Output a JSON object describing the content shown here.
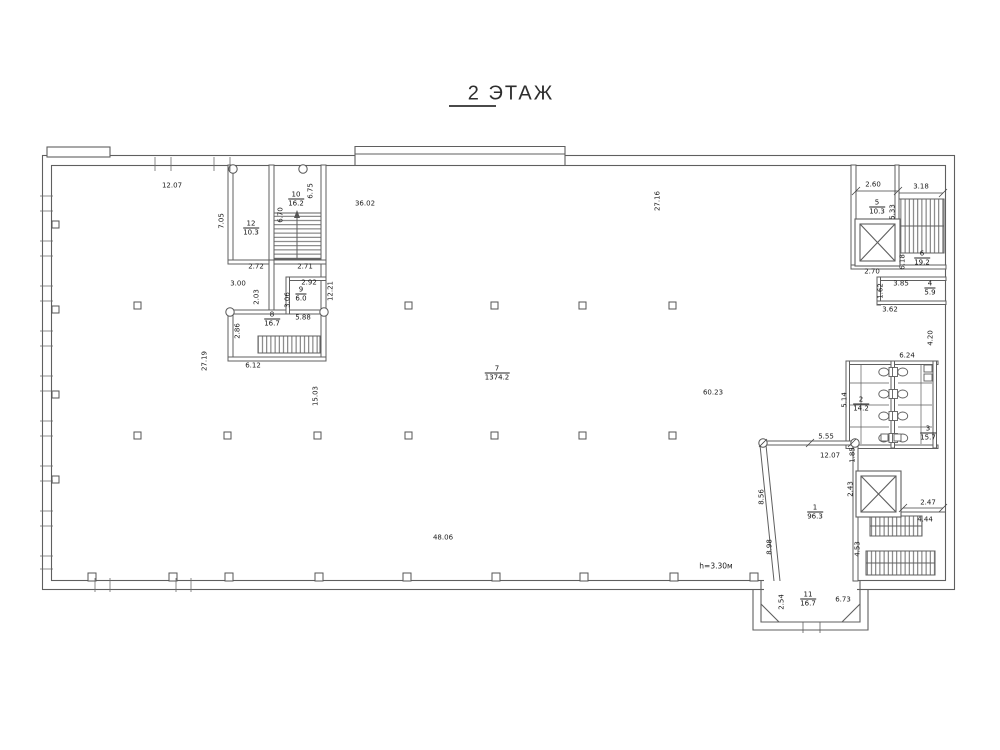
{
  "title": {
    "text": "2 ЭТАЖ"
  },
  "plan": {
    "colors": {
      "line": "#5f5f5f",
      "text": "#1c1c1c",
      "background": "#ffffff"
    },
    "floor_height_note": {
      "text": "h=3.30м",
      "x": 716,
      "y": 566
    },
    "rooms": [
      {
        "number": "12",
        "area": "10.3",
        "x": 251,
        "y": 228
      },
      {
        "number": "10",
        "area": "16.2",
        "x": 296,
        "y": 199
      },
      {
        "number": "9",
        "area": "6.0",
        "x": 301,
        "y": 294
      },
      {
        "number": "8",
        "area": "16.7",
        "x": 272,
        "y": 319
      },
      {
        "number": "7",
        "area": "1374.2",
        "x": 497,
        "y": 373
      },
      {
        "number": "5",
        "area": "10.3",
        "x": 877,
        "y": 207
      },
      {
        "number": "6",
        "area": "19.2",
        "x": 922,
        "y": 258
      },
      {
        "number": "4",
        "area": "5.9",
        "x": 930,
        "y": 288
      },
      {
        "number": "2",
        "area": "14.2",
        "x": 861,
        "y": 404
      },
      {
        "number": "3",
        "area": "15.7",
        "x": 928,
        "y": 433
      },
      {
        "number": "1",
        "area": "96.3",
        "x": 815,
        "y": 512
      },
      {
        "number": "11",
        "area": "16.7",
        "x": 808,
        "y": 599
      }
    ],
    "h_dims": [
      {
        "text": "12.07",
        "x": 172,
        "y": 186
      },
      {
        "text": "36.02",
        "x": 365,
        "y": 204
      },
      {
        "text": "2.60",
        "x": 873,
        "y": 185
      },
      {
        "text": "3.18",
        "x": 921,
        "y": 187
      },
      {
        "text": "2.70",
        "x": 872,
        "y": 272
      },
      {
        "text": "3.85",
        "x": 901,
        "y": 284
      },
      {
        "text": "3.62",
        "x": 890,
        "y": 310
      },
      {
        "text": "6.24",
        "x": 907,
        "y": 356
      },
      {
        "text": "2.72",
        "x": 256,
        "y": 267
      },
      {
        "text": "2.71",
        "x": 305,
        "y": 267
      },
      {
        "text": "3.00",
        "x": 238,
        "y": 284
      },
      {
        "text": "2.92",
        "x": 309,
        "y": 283
      },
      {
        "text": "5.88",
        "x": 303,
        "y": 318
      },
      {
        "text": "6.12",
        "x": 253,
        "y": 366
      },
      {
        "text": "5.55",
        "x": 826,
        "y": 437
      },
      {
        "text": "12.07",
        "x": 830,
        "y": 456
      },
      {
        "text": "60.23",
        "x": 713,
        "y": 393
      },
      {
        "text": "48.06",
        "x": 443,
        "y": 538
      },
      {
        "text": "2.47",
        "x": 928,
        "y": 503
      },
      {
        "text": "4.44",
        "x": 925,
        "y": 520
      },
      {
        "text": "6.73",
        "x": 843,
        "y": 600
      }
    ],
    "v_dims": [
      {
        "text": "7.05",
        "x": 222,
        "y": 221
      },
      {
        "text": "6.70",
        "x": 281,
        "y": 215
      },
      {
        "text": "6.75",
        "x": 311,
        "y": 191
      },
      {
        "text": "27.16",
        "x": 658,
        "y": 201
      },
      {
        "text": "5.33",
        "x": 893,
        "y": 212
      },
      {
        "text": "6.18",
        "x": 903,
        "y": 262
      },
      {
        "text": "1.62",
        "x": 881,
        "y": 291
      },
      {
        "text": "4.20",
        "x": 931,
        "y": 338
      },
      {
        "text": "5.14",
        "x": 845,
        "y": 400
      },
      {
        "text": "1.85",
        "x": 853,
        "y": 455
      },
      {
        "text": "2.43",
        "x": 851,
        "y": 489
      },
      {
        "text": "4.53",
        "x": 858,
        "y": 549
      },
      {
        "text": "8.56",
        "x": 762,
        "y": 497
      },
      {
        "text": "8.98",
        "x": 770,
        "y": 547
      },
      {
        "text": "2.54",
        "x": 782,
        "y": 602
      },
      {
        "text": "12.21",
        "x": 331,
        "y": 291
      },
      {
        "text": "3.06",
        "x": 288,
        "y": 300
      },
      {
        "text": "2.03",
        "x": 257,
        "y": 297
      },
      {
        "text": "27.19",
        "x": 205,
        "y": 361
      },
      {
        "text": "15.03",
        "x": 316,
        "y": 396
      },
      {
        "text": "2.86",
        "x": 238,
        "y": 331
      }
    ]
  }
}
